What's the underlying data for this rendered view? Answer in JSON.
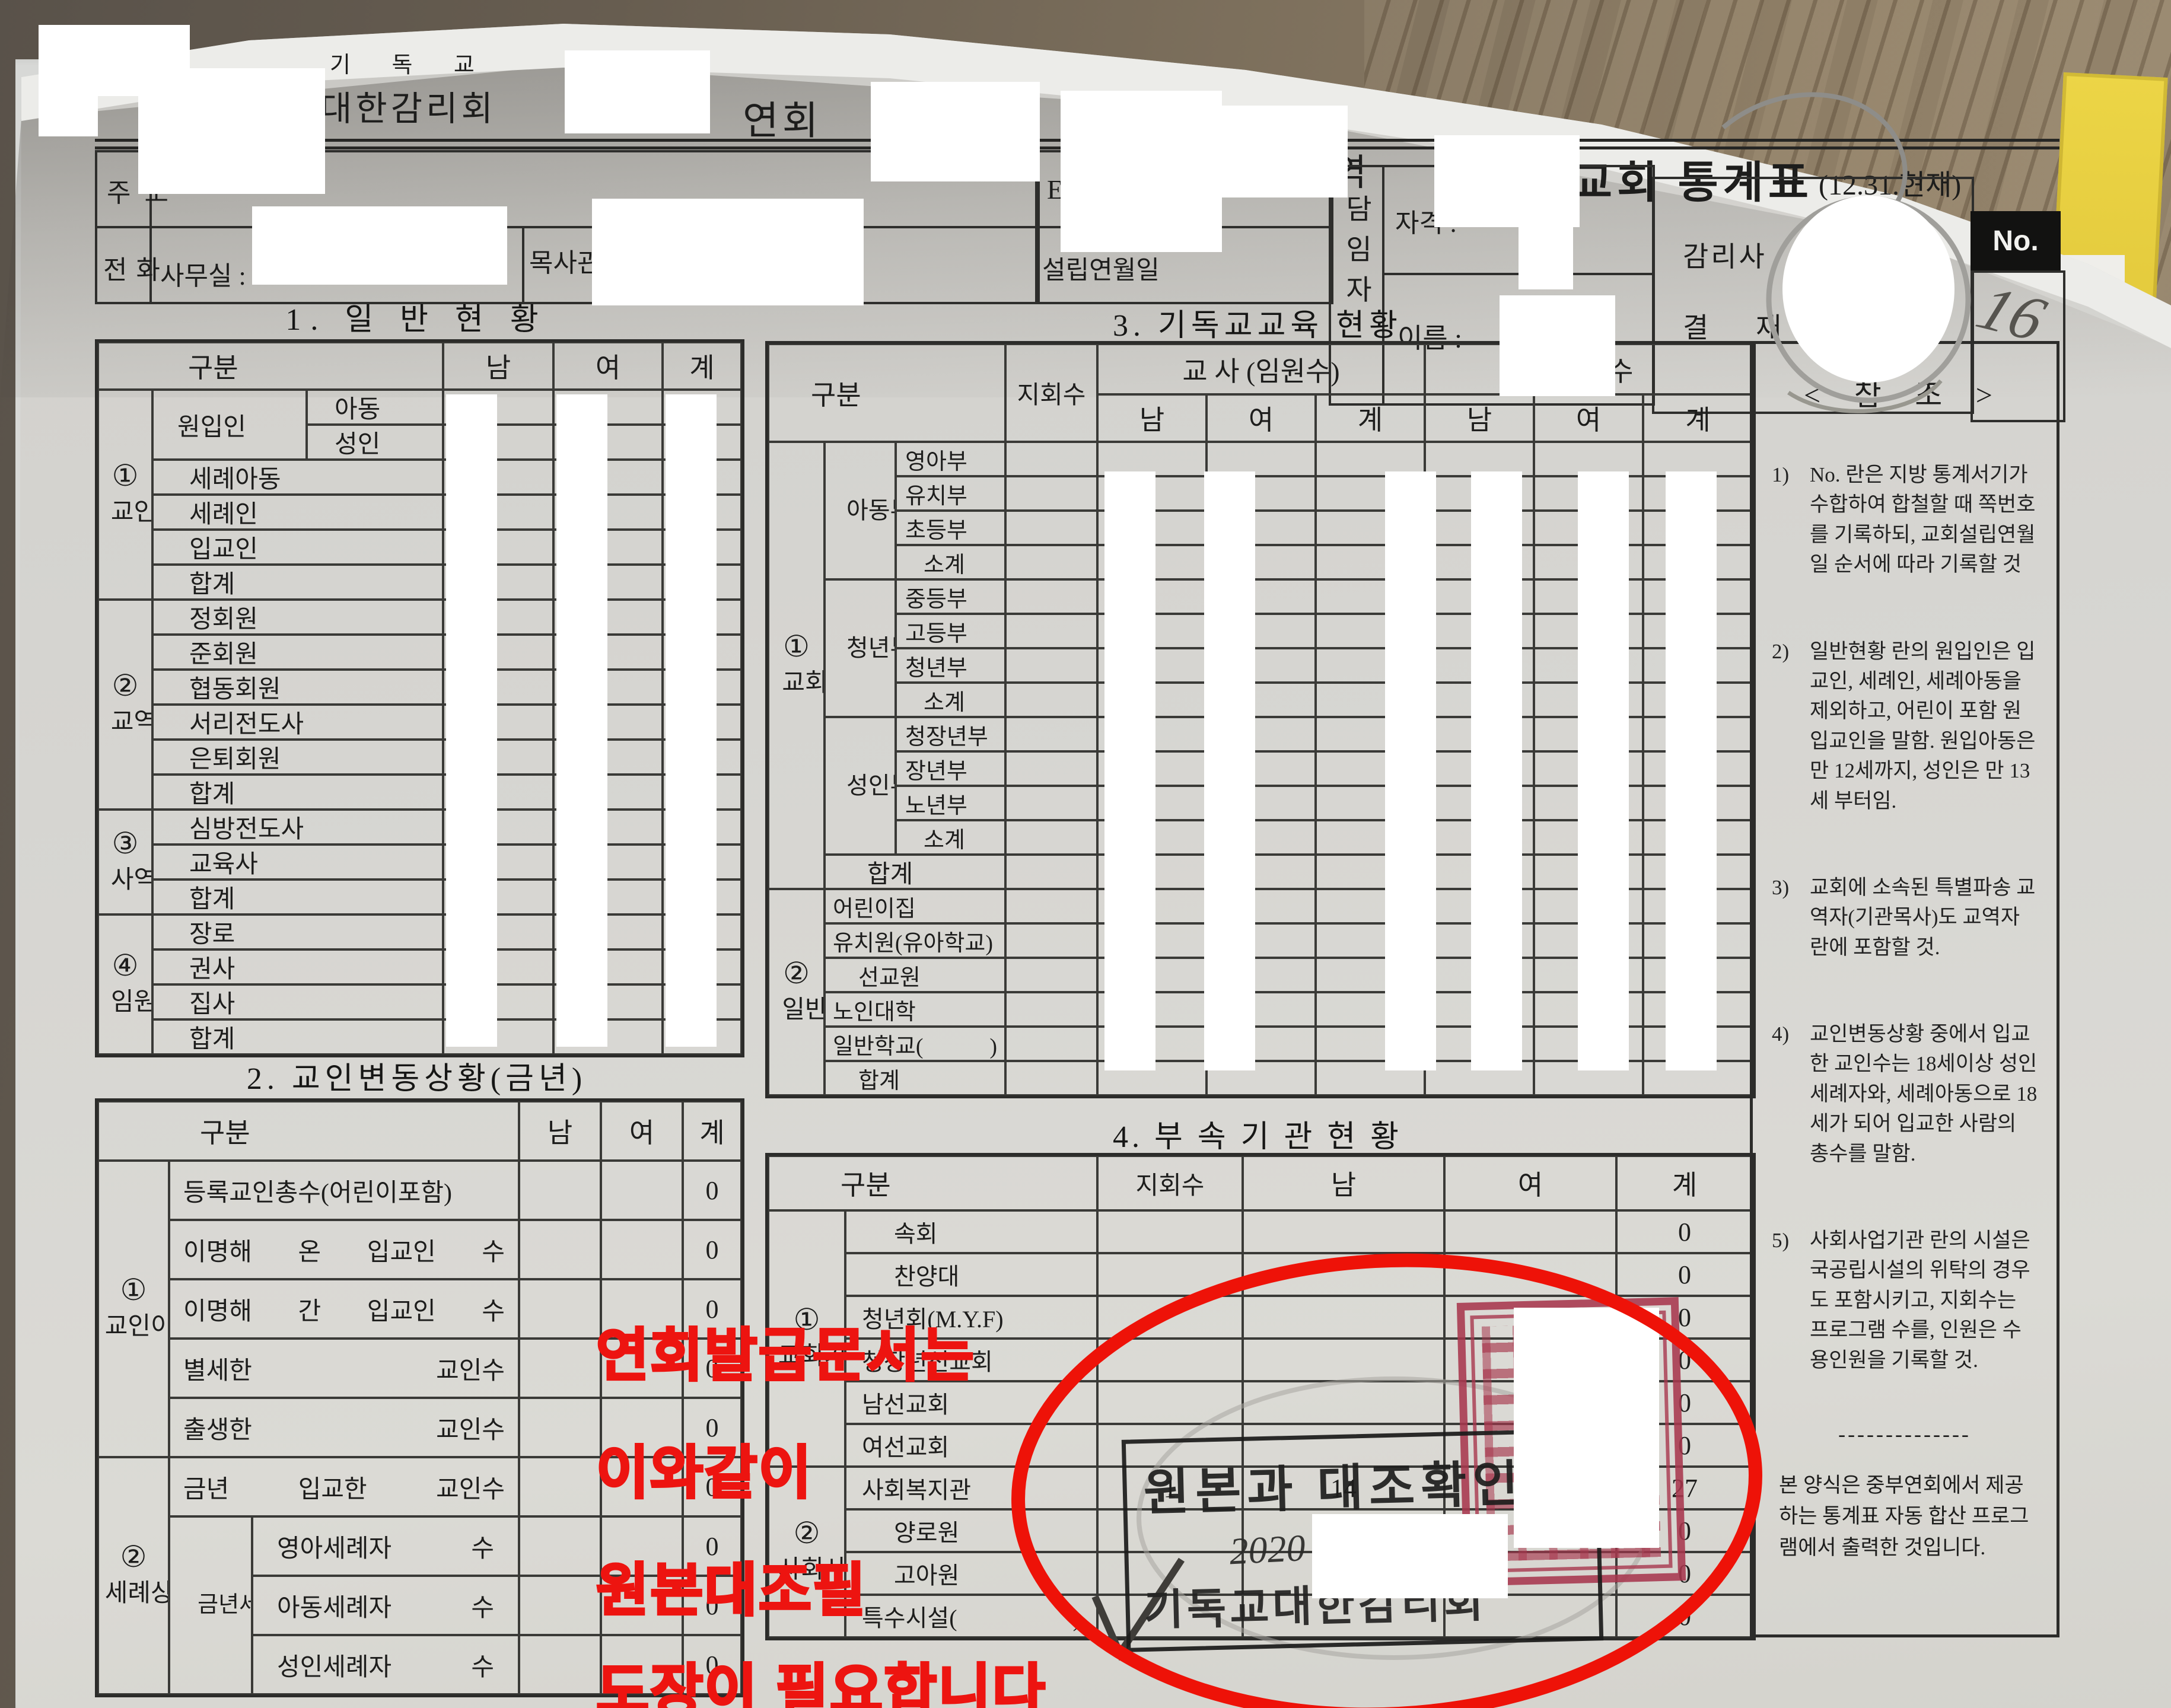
{
  "header": {
    "year_suffix": "년도",
    "denomination_small": "기 독 교",
    "denomination_large": "대한감리회",
    "conference_suffix": "연회",
    "district_suffix": "지방",
    "circuit_suffix": "구역",
    "doc_title": "교회 통계표",
    "as_of_note": "(12.31.현재)"
  },
  "contact": {
    "address_label": "주 소",
    "phone_label": "전 화",
    "office_label": "사무실 :",
    "parsonage_label": "목사관 :",
    "email_label": "E-Mail",
    "founded_label": "설립연월일",
    "pastor_label": "담임자",
    "qualification_label": "자격 :",
    "name_label": "이름 :",
    "superintendent_line1": "감리사",
    "superintendent_line2": "결 재",
    "no_label": "No.",
    "handwritten_no": "16"
  },
  "section1": {
    "title": "1.  일 반 현 황",
    "headers": {
      "gubun": "구분",
      "nam": "남",
      "yeo": "여",
      "gye": "계"
    },
    "groups": [
      {
        "no": "①",
        "name": "교인",
        "rows": [
          {
            "mid": "원입인",
            "sub": "아동"
          },
          {
            "sub": "성인"
          },
          {
            "label": "세례아동"
          },
          {
            "label": "세례인"
          },
          {
            "label": "입교인"
          },
          {
            "label": "합계"
          }
        ]
      },
      {
        "no": "②",
        "name": "교역자",
        "rows": [
          {
            "label": "정회원"
          },
          {
            "label": "준회원"
          },
          {
            "label": "협동회원"
          },
          {
            "label": "서리전도사"
          },
          {
            "label": "은퇴회원"
          },
          {
            "label": "합계"
          }
        ]
      },
      {
        "no": "③",
        "name": "사역자",
        "rows": [
          {
            "label": "심방전도사"
          },
          {
            "label": "교육사"
          },
          {
            "label": "합계"
          }
        ]
      },
      {
        "no": "④",
        "name": "임원",
        "rows": [
          {
            "label": "장로"
          },
          {
            "label": "권사"
          },
          {
            "label": "집사"
          },
          {
            "label": "합계"
          }
        ]
      }
    ]
  },
  "section2": {
    "title": "2. 교인변동상황(금년)",
    "headers": {
      "gubun": "구분",
      "nam": "남",
      "yeo": "여",
      "gye": "계"
    },
    "groups": [
      {
        "no": "①",
        "name": "교인이동상황",
        "rows": [
          {
            "label": "등록교인총수(어린이포함)",
            "gye": "0"
          },
          {
            "label": "이명해 온 입교인 수",
            "gye": "0"
          },
          {
            "label": "이명해 간 입교인 수",
            "gye": "0"
          },
          {
            "label": "별세한 교인수",
            "gye": "0"
          },
          {
            "label": "출생한 교인수",
            "gye": "0"
          }
        ]
      },
      {
        "no": "②",
        "name": "세례상황",
        "rows": [
          {
            "label": "금년 입교한 교인수",
            "gye": "0"
          },
          {
            "mid": "금년세례자",
            "sub": "영아세례자 수",
            "gye": "0"
          },
          {
            "sub": "아동세례자 수",
            "gye": "0"
          },
          {
            "sub": "성인세례자 수",
            "gye": "0"
          }
        ]
      }
    ]
  },
  "section3": {
    "title": "3. 기독교교육 현황",
    "headers": {
      "gubun": "구분",
      "jihoe": "지회수",
      "teachers": "교 사 (임원수)",
      "students": "학 생 수",
      "nam": "남",
      "yeo": "여",
      "gye": "계"
    },
    "church_school": {
      "no": "①",
      "name": "교회학교",
      "subgroups": [
        {
          "name": "아동부",
          "rows": [
            "영아부",
            "유치부",
            "초등부",
            "소계"
          ]
        },
        {
          "name": "청년부",
          "rows": [
            "중등부",
            "고등부",
            "청년부",
            "소계"
          ]
        },
        {
          "name": "성인부",
          "rows": [
            "청장년부",
            "장년부",
            "노년부",
            "소계"
          ]
        }
      ],
      "total_label": "합계"
    },
    "general_edu": {
      "no": "②",
      "name": "일반교육",
      "rows": [
        "어린이집",
        "유치원(유아학교)",
        "선교원",
        "노인대학",
        "일반학교(     )",
        "합계"
      ]
    }
  },
  "section4": {
    "title": "4. 부 속 기 관 현 황",
    "headers": {
      "gubun": "구분",
      "jihoe": "지회수",
      "nam": "남",
      "yeo": "여",
      "gye": "계"
    },
    "groups": [
      {
        "no": "①",
        "name": "교회기관",
        "rows": [
          {
            "label": "속회",
            "gye": "0"
          },
          {
            "label": "찬양대",
            "gye": "0"
          },
          {
            "label": "청년회(M.Y.F)",
            "gye": "0"
          },
          {
            "label": "청장년선교회",
            "gye": "0"
          },
          {
            "label": "남선교회",
            "gye": "0"
          },
          {
            "label": "여선교회",
            "gye": "0"
          }
        ]
      },
      {
        "no": "②",
        "name": "사회사업기관",
        "rows": [
          {
            "label": "사회복지관",
            "jihoe": "1",
            "nam": "14",
            "yeo": "13",
            "gye": "27"
          },
          {
            "label": "양로원",
            "gye": "0"
          },
          {
            "label": "고아원",
            "gye": "0"
          },
          {
            "label": "특수시설(    )",
            "gye": "0"
          }
        ]
      }
    ]
  },
  "notes": {
    "title": "< 참  조 >",
    "items": [
      {
        "num": "1)",
        "text": "No. 란은 지방 통계서기가 수합하여 합철할 때 쪽번호를 기록하되, 교회설립연월일 순서에 따라 기록할 것"
      },
      {
        "num": "2)",
        "text": "일반현황 란의 원입인은 입교인, 세례인, 세례아동을 제외하고, 어린이 포함 원입교인을 말함. 원입아동은 만 12세까지, 성인은 만 13세 부터임."
      },
      {
        "num": "3)",
        "text": "교회에 소속된 특별파송 교역자(기관목사)도 교역자란에 포함할 것."
      },
      {
        "num": "4)",
        "text": "교인변동상황 중에서 입교한 교인수는 18세이상 성인세례자와, 세례아동으로 18세가 되어 입교한 사람의 총수를 말함."
      },
      {
        "num": "5)",
        "text": "사회사업기관 란의 시설은 국공립시설의 위탁의 경우도 포함시키고, 지회수는 프로그램 수를, 인원은 수용인원을 기록할 것."
      }
    ],
    "divider": "--------------",
    "footer": "본 양식은 중부연회에서 제공하는 통계표 자동 합산 프로그램에서 출력한 것입니다."
  },
  "annotations": {
    "red_color": "#ed1410",
    "red_note_lines": [
      "연회발급문서는",
      "이와같이",
      "원본대조필",
      "도장이 필요합니다"
    ],
    "stamp": {
      "line1": "원본과 대조확인",
      "date_line": "2020 년 8월 27일",
      "org_line": "기독교대한감리회"
    },
    "checkmark": "✓"
  }
}
